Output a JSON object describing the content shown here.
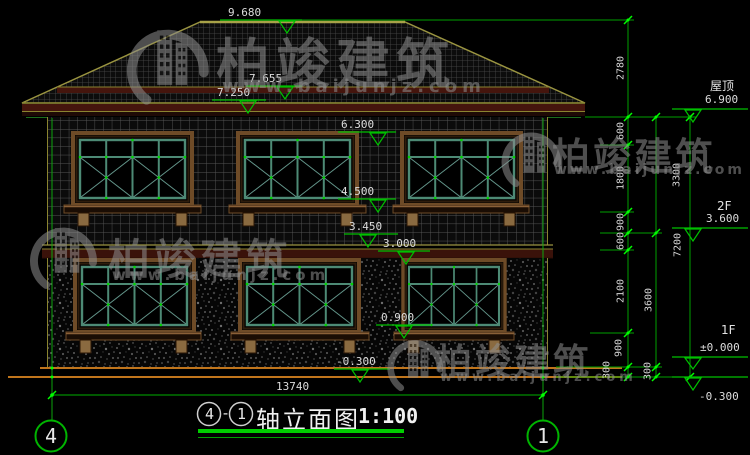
{
  "title": {
    "axis_left": "4",
    "separator": "-",
    "axis_right": "1",
    "text": "轴立面图",
    "scale": "1:100"
  },
  "axis_bubbles": {
    "left": "4",
    "right": "1"
  },
  "floor_labels": {
    "roof": "屋顶",
    "f2": "2F",
    "f1": "1F"
  },
  "watermark": {
    "brand": "柏竣建筑",
    "url": "www.baijunjz.com"
  },
  "elevations": {
    "ridge": "9.680",
    "eave_top": "7.655",
    "eave_bottom": "7.250",
    "win2_head": "6.300",
    "win2_sill": "4.500",
    "belt_top": "3.450",
    "floor2": "3.000",
    "win1_sill": "0.900",
    "grade_center": "-0.300",
    "roof_right": "6.900",
    "floor2_right": "3.600",
    "floor1_right": "±0.000",
    "grade_right": "-0.300"
  },
  "dims": {
    "total": "13740",
    "c1": [
      "2780",
      "600",
      "1800",
      "900",
      "600",
      "2100",
      "900",
      "300"
    ],
    "c2": [
      "3300",
      "3600",
      "300"
    ],
    "c3": [
      "7200"
    ]
  },
  "colors": {
    "line_green": "#00b400",
    "bright_green": "#00ff00",
    "ground_orange": "#c0751c",
    "frame_brown": "#6e4b27",
    "frame_teal": "#4d8a75",
    "edge_olive": "#9a9440",
    "band_maroon": "#45150d",
    "watermark_gray": "#8f8f8f",
    "text": "#dcdcdc"
  }
}
